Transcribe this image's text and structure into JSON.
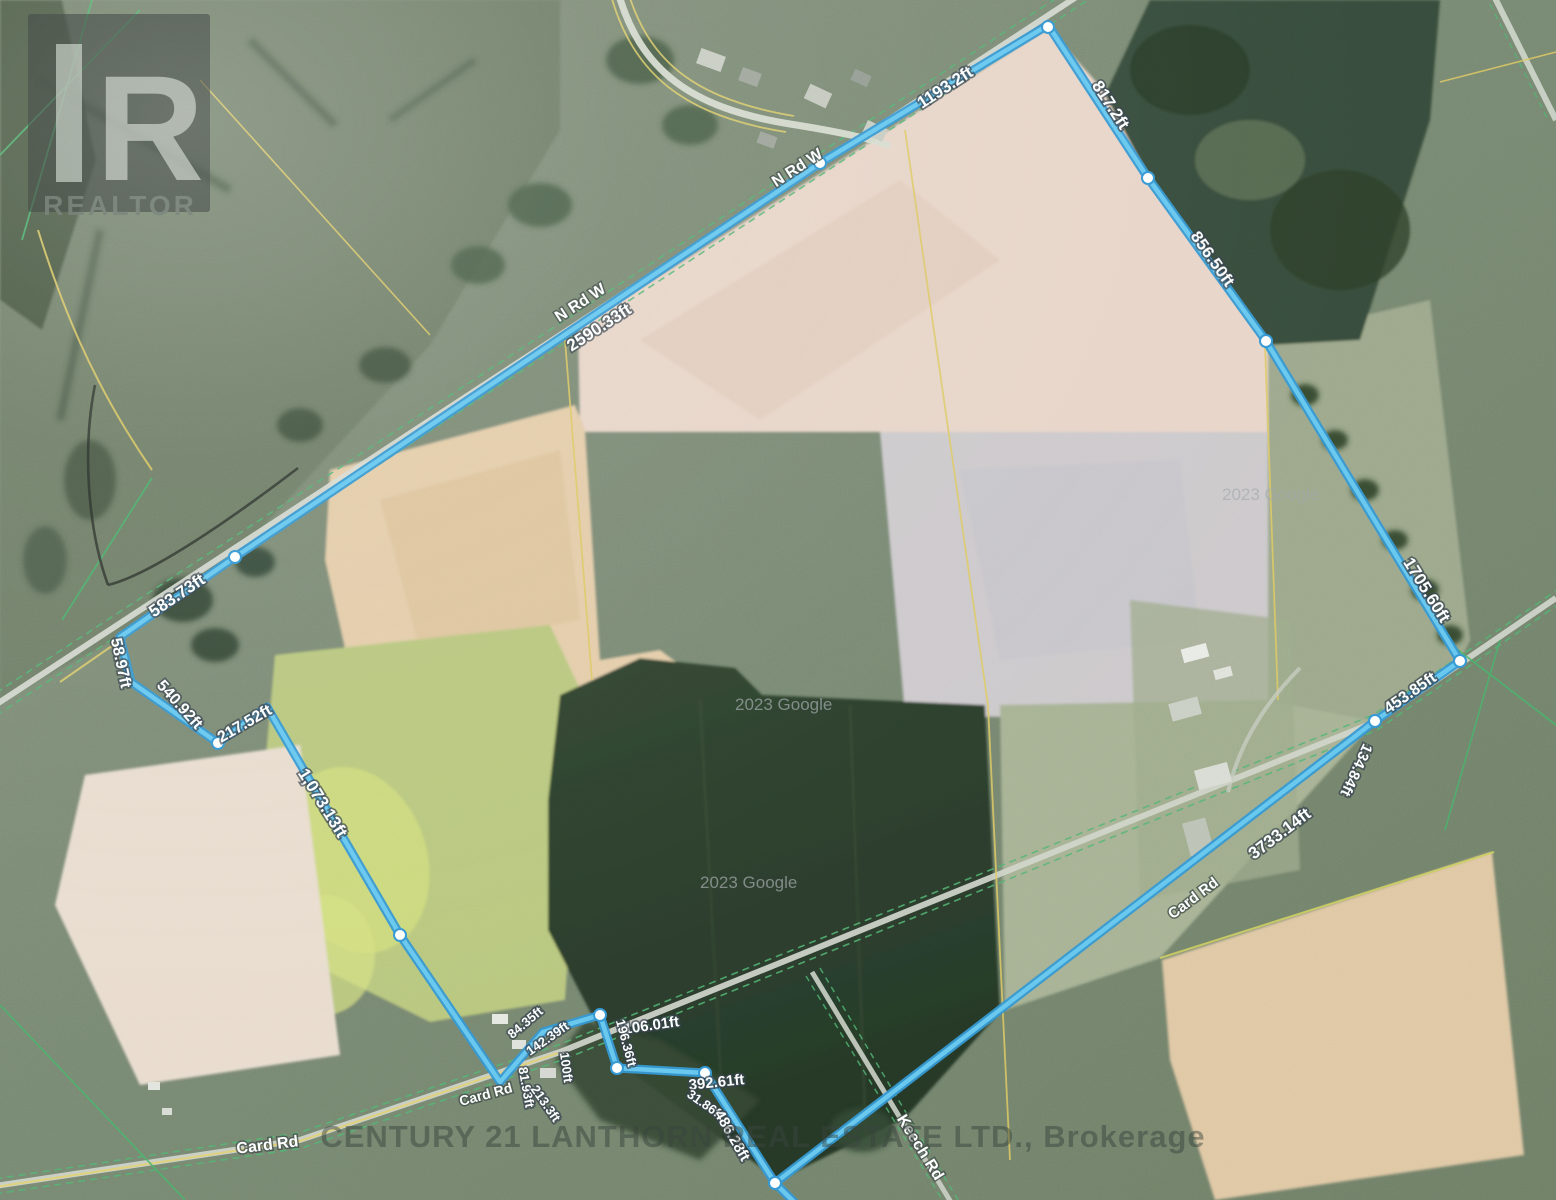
{
  "logo": {
    "letter": "R",
    "word": "REALTOR"
  },
  "watermarks": {
    "brokerage": "CENTURY 21 LANTHORN REAL ESTATE LTD., Brokerage",
    "google_credit_1": "2023 Google",
    "google_credit_2": "2023 Google",
    "google_credit_3": "2023 Google"
  },
  "boundary": {
    "color": "#4fb6e8",
    "measurements": [
      {
        "text": "1193.2ft"
      },
      {
        "text": "2590.33ft"
      },
      {
        "text": "817.2ft"
      },
      {
        "text": "856.50ft"
      },
      {
        "text": "1705.60ft"
      },
      {
        "text": "453.85ft"
      },
      {
        "text": "134.84ft"
      },
      {
        "text": "3733.14ft"
      },
      {
        "text": "583.73ft"
      },
      {
        "text": "58.97ft"
      },
      {
        "text": "540.92ft"
      },
      {
        "text": "217.52ft"
      },
      {
        "text": "1,073.13ft"
      },
      {
        "text": "84.35ft"
      },
      {
        "text": "142.39ft"
      },
      {
        "text": "100ft"
      },
      {
        "text": "81.93ft"
      },
      {
        "text": "213.3ft"
      },
      {
        "text": "106.01ft"
      },
      {
        "text": "196.36ft"
      },
      {
        "text": "392.61ft"
      },
      {
        "text": "31.86ft"
      },
      {
        "text": "486.28ft"
      }
    ]
  },
  "roads": [
    {
      "text": "N Rd W"
    },
    {
      "text": "N Rd W"
    },
    {
      "text": "Card Rd"
    },
    {
      "text": "Card Rd"
    },
    {
      "text": "Card Rd"
    },
    {
      "text": "Keech Rd"
    }
  ]
}
